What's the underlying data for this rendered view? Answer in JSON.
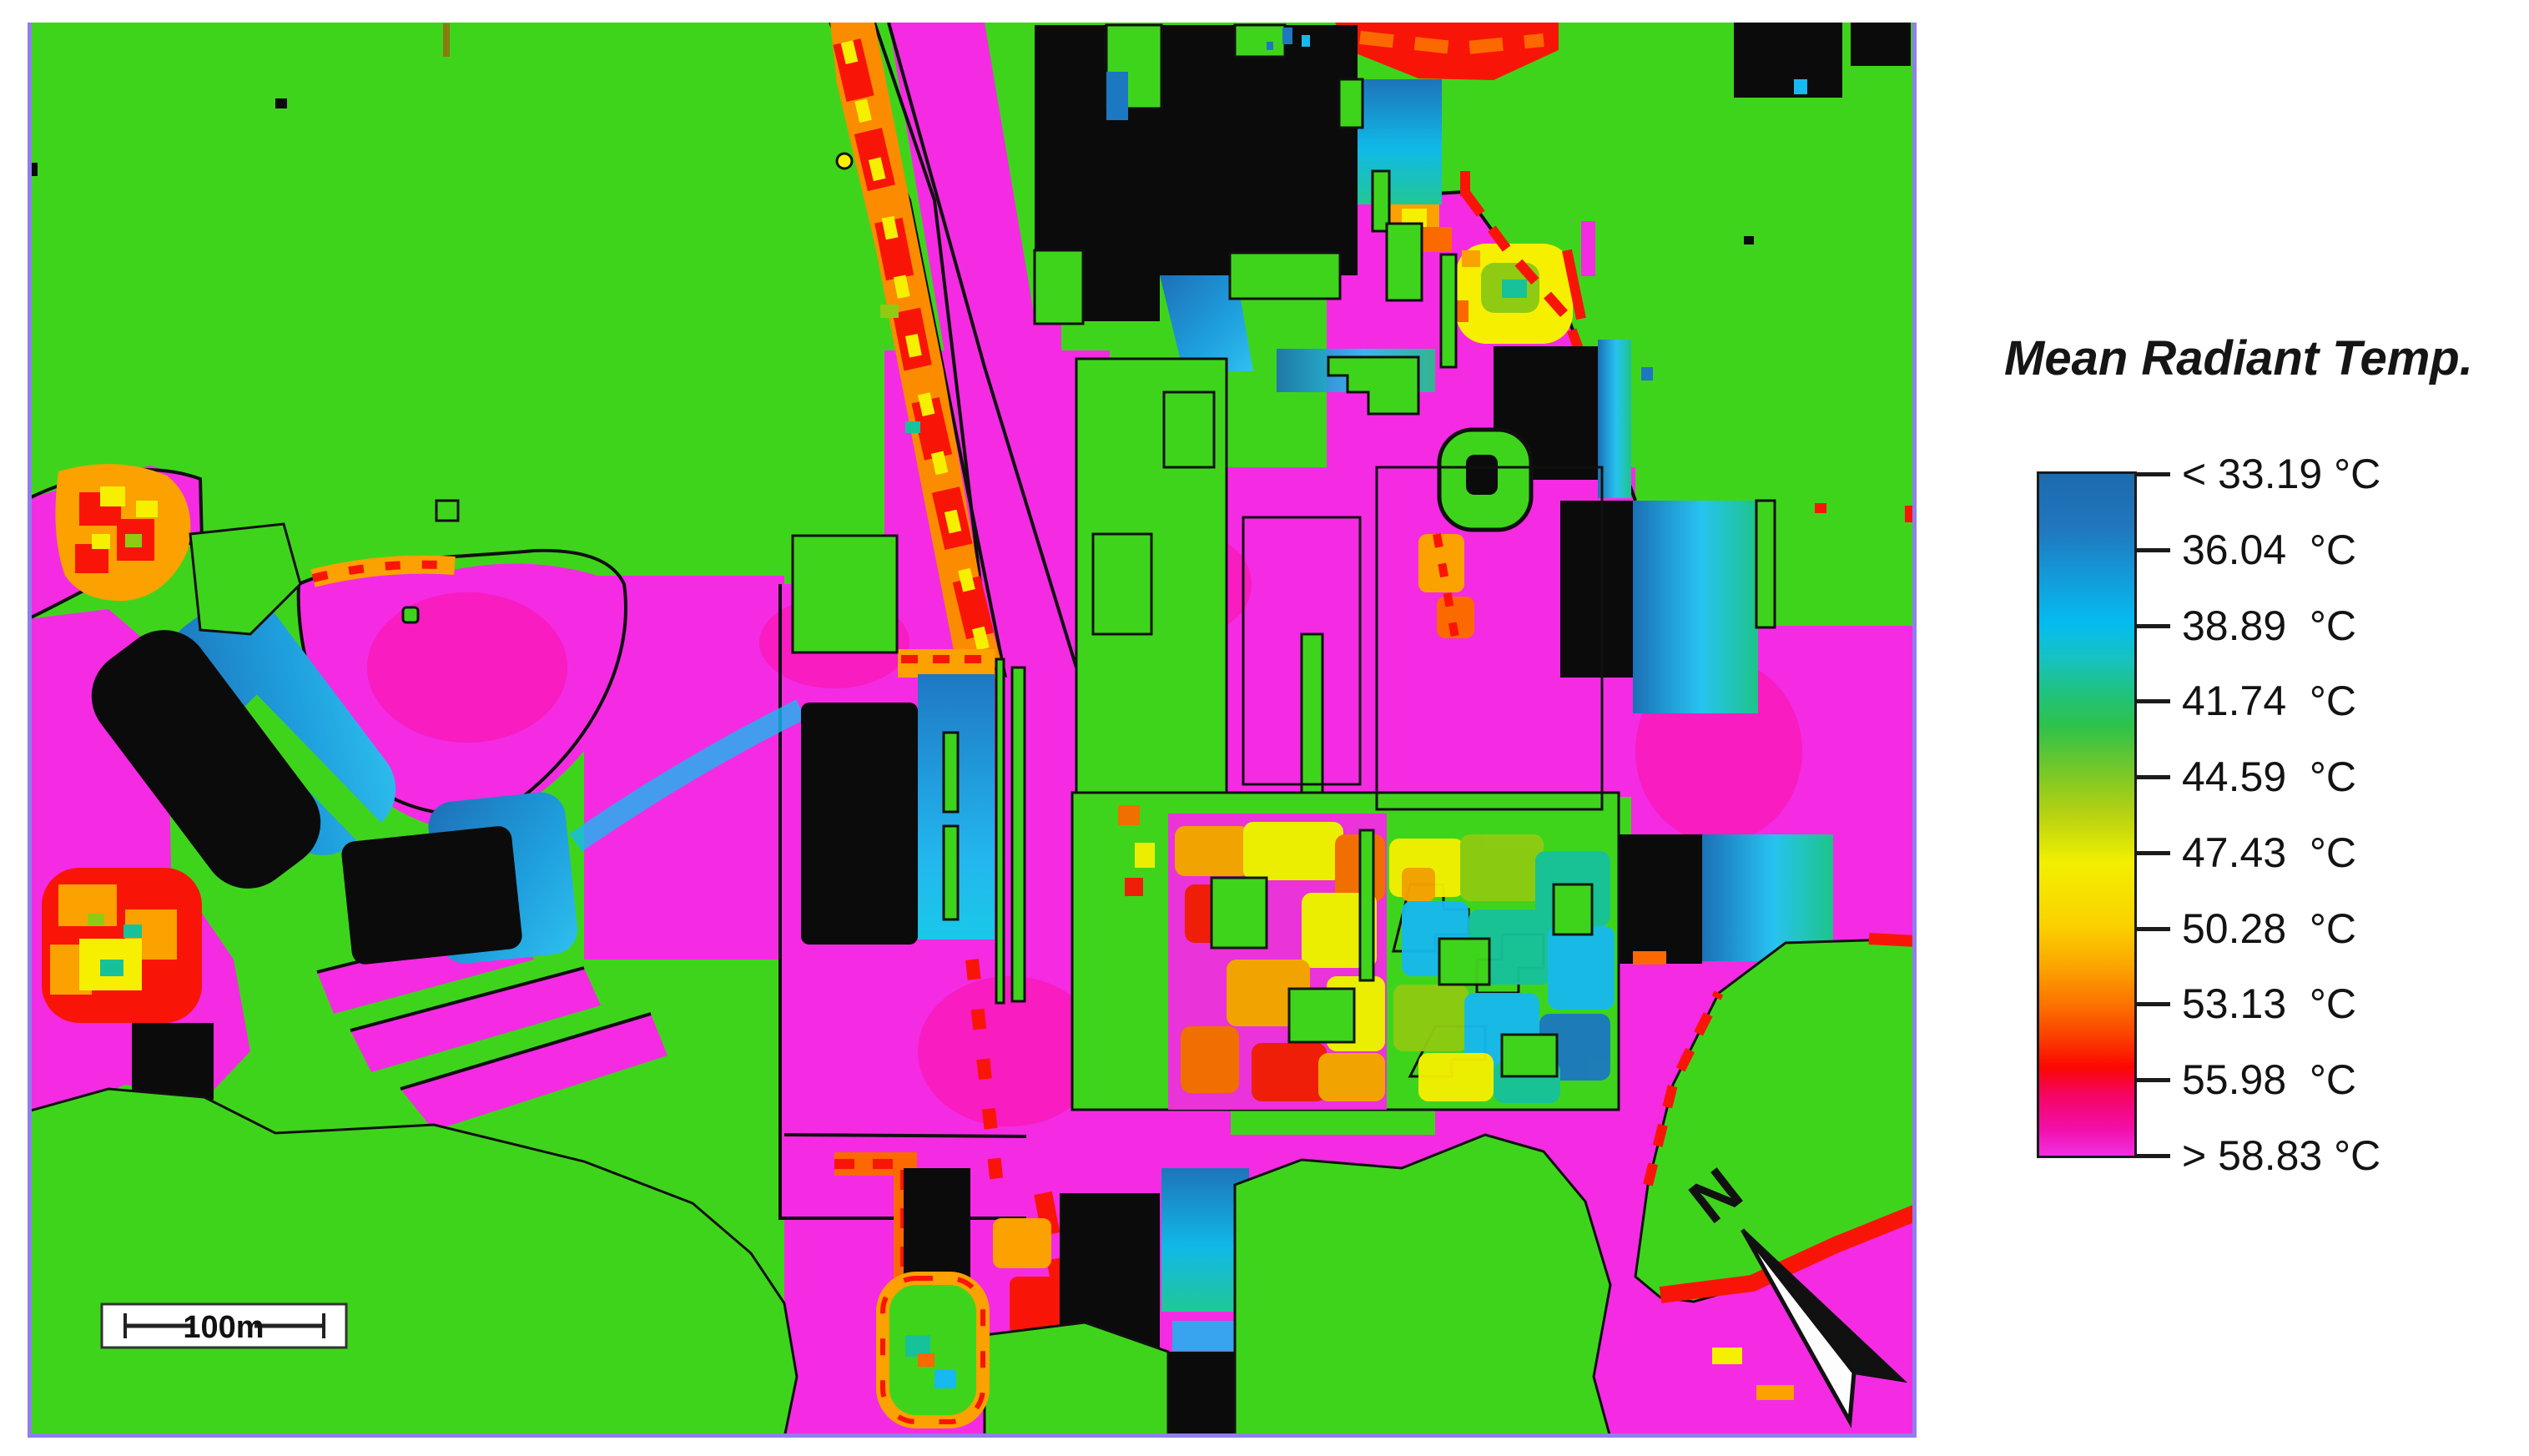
{
  "legend": {
    "title": "Mean Radiant Temp.",
    "labels": [
      "< 33.19 °C",
      "36.04  °C",
      "38.89  °C",
      "41.74  °C",
      "44.59  °C",
      "47.43  °C",
      "50.28  °C",
      "53.13  °C",
      "55.98  °C",
      "> 58.83 °C"
    ],
    "gradient_stops": [
      {
        "offset": 0.0,
        "color": "#1D6AAE"
      },
      {
        "offset": 0.08,
        "color": "#2077BE"
      },
      {
        "offset": 0.16,
        "color": "#129FDD"
      },
      {
        "offset": 0.22,
        "color": "#04BCF0"
      },
      {
        "offset": 0.27,
        "color": "#16C2C2"
      },
      {
        "offset": 0.32,
        "color": "#1FC280"
      },
      {
        "offset": 0.37,
        "color": "#2EC24A"
      },
      {
        "offset": 0.44,
        "color": "#7BC827"
      },
      {
        "offset": 0.5,
        "color": "#B7D212"
      },
      {
        "offset": 0.57,
        "color": "#F2F000"
      },
      {
        "offset": 0.66,
        "color": "#FBD200"
      },
      {
        "offset": 0.72,
        "color": "#FBA700"
      },
      {
        "offset": 0.78,
        "color": "#FB7100"
      },
      {
        "offset": 0.83,
        "color": "#FB3A00"
      },
      {
        "offset": 0.87,
        "color": "#FB0801"
      },
      {
        "offset": 0.91,
        "color": "#F50560"
      },
      {
        "offset": 0.96,
        "color": "#F30FA8"
      },
      {
        "offset": 1.0,
        "color": "#F02FE2"
      }
    ]
  },
  "map": {
    "scale_bar_label": "100m",
    "north_label": "N"
  },
  "chart_data": {
    "type": "heatmap",
    "title": "Mean Radiant Temp.",
    "unit": "°C",
    "colorbar_ticks": [
      33.19,
      36.04,
      38.89,
      41.74,
      44.59,
      47.43,
      50.28,
      53.13,
      55.98,
      58.83
    ],
    "colorbar_tick_labels": [
      "< 33.19 °C",
      "36.04  °C",
      "38.89  °C",
      "41.74  °C",
      "44.59  °C",
      "47.43  °C",
      "50.28  °C",
      "53.13  °C",
      "55.98  °C",
      "> 58.83 °C"
    ],
    "colorbar_open_ended": true,
    "legend_position": "right",
    "scale_bar": "100m",
    "north_arrow": "pointing upper-left (NW)",
    "palette": {
      "vegetation_green": "#3FD41C",
      "hot_magenta": "#F42BE3",
      "deep_pink": "#FB0DA0",
      "building_black": "#0B0B0B",
      "shadow_blue": "#1C78C0",
      "shadow_cyan": "#16B9F0",
      "teal": "#17C29B",
      "lime": "#8FCB12",
      "yellow": "#F6F000",
      "orange": "#FBA100",
      "deep_orange": "#FB6900",
      "red": "#F81508",
      "map_border_violet": "#8F7FEC"
    },
    "map_features": [
      "urban microclimate raster: green = ~41-44 °C vegetated ground",
      "magenta/pink = >55 °C sun-exposed paving and roads",
      "black polygons = buildings (no value)",
      "blue/cyan gradients = <39 °C shaded zones on NE sides of buildings",
      "yellow/orange/red mottled streaks = 44-53 °C transition zones along road edges and tree park",
      "central park with mottled cyan/teal/yellow canopy temperatures",
      "scale bar 100 m bottom-left, north arrow bottom-right rotated toward NW"
    ]
  }
}
